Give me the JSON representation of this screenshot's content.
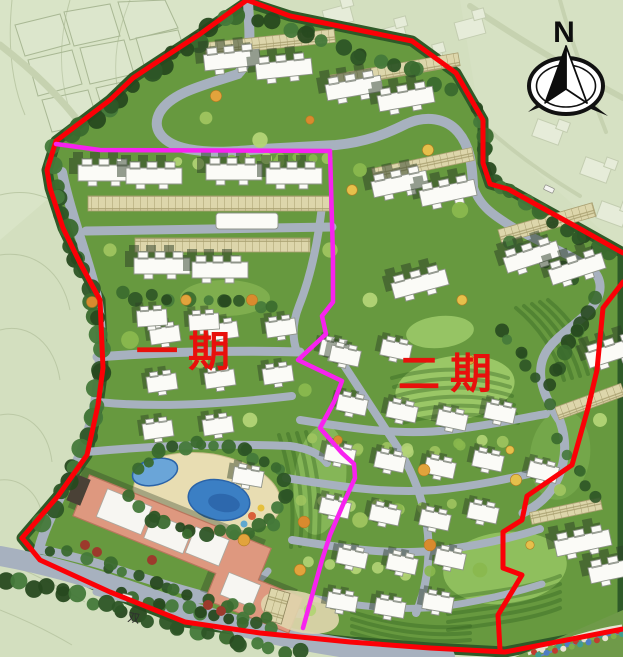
{
  "labels": {
    "phase1": "一期",
    "phase2": "二期",
    "road_name": "双",
    "compass_north": "N"
  },
  "colors": {
    "boundary_red": "#fb0006",
    "phase_line": "#f722ef",
    "label_red": "#e8100c",
    "context_green": "#d3dfbf",
    "site_green": "#67993f",
    "tree_dark": "#2e5626",
    "lawn_light": "#a4cb6c",
    "road_gray": "#a7b1bf",
    "building_white": "#fbfbf7",
    "clubhouse_salmon": "#de987f",
    "pool_blue": "#3b7fc4",
    "parking_beige": "#ddd6ab"
  }
}
